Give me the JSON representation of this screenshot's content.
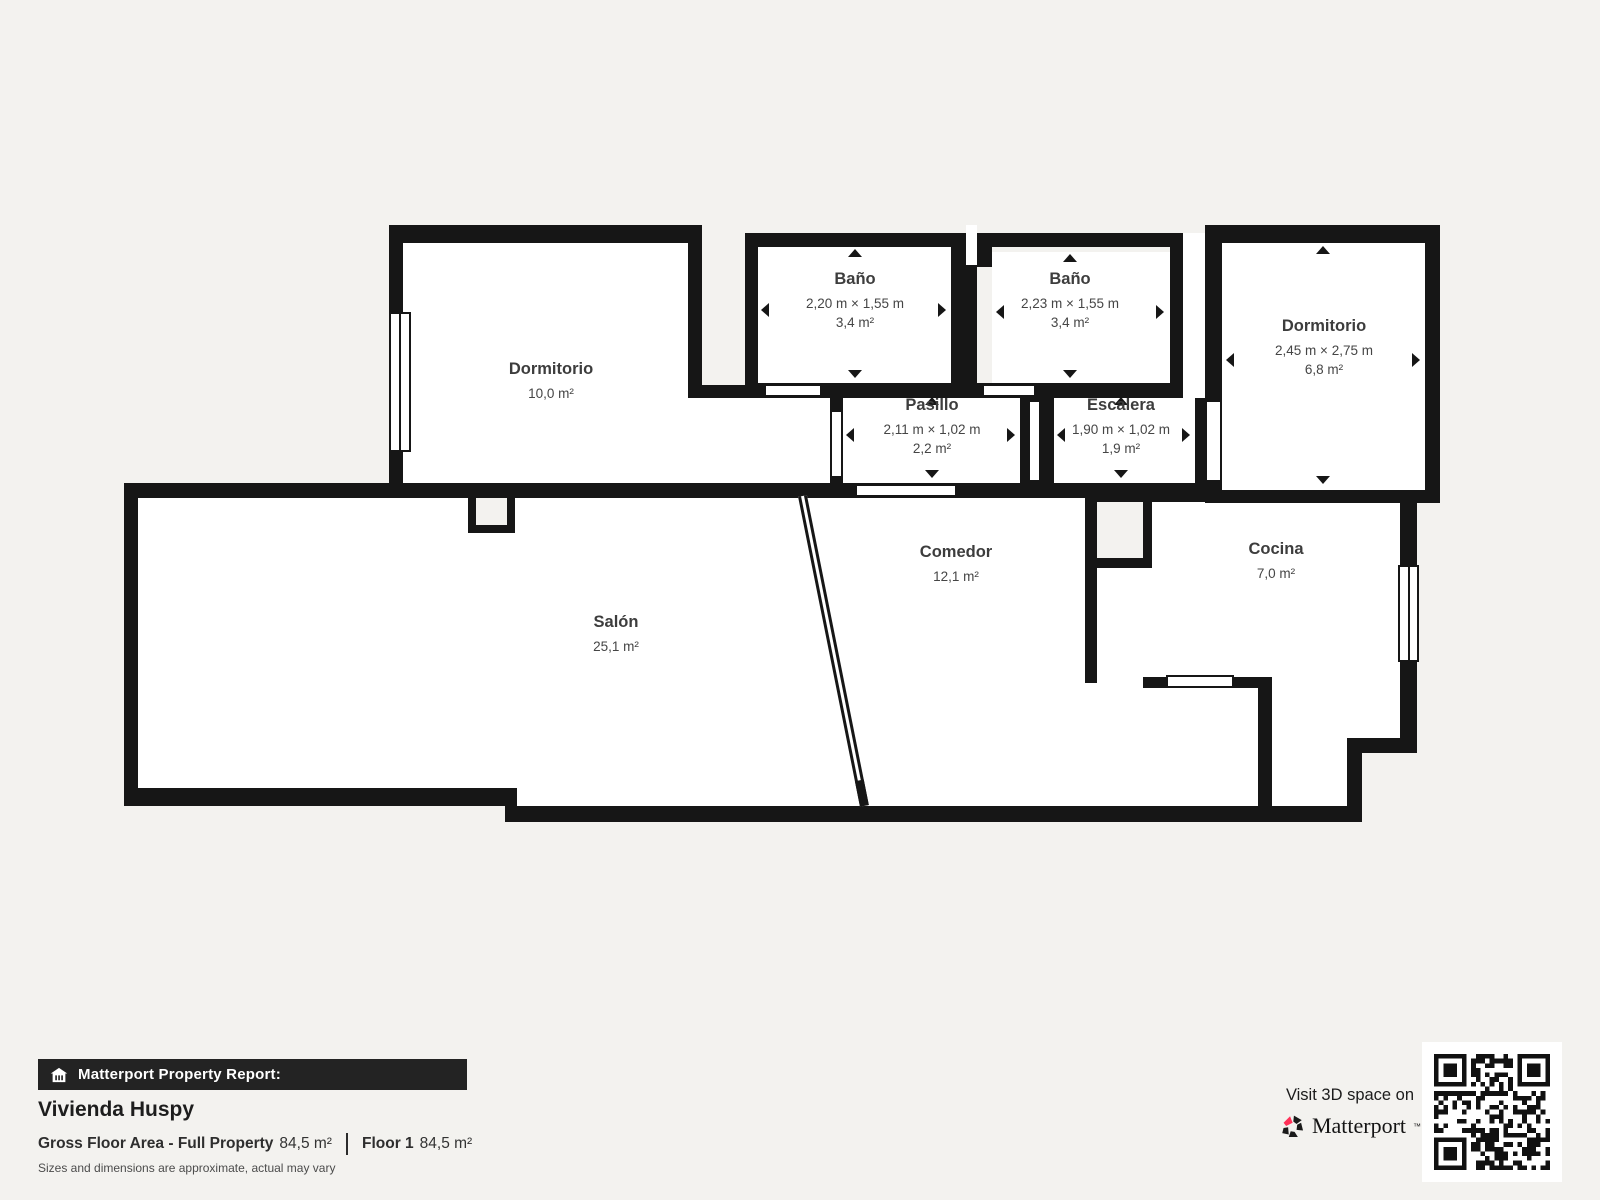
{
  "plan": {
    "rooms": {
      "dormitorio_left": {
        "name": "Dormitorio",
        "area": "10,0 m²"
      },
      "bano1": {
        "name": "Baño",
        "dims": "2,20 m × 1,55 m",
        "area": "3,4 m²"
      },
      "bano2": {
        "name": "Baño",
        "dims": "2,23 m × 1,55 m",
        "area": "3,4 m²"
      },
      "dormitorio_right": {
        "name": "Dormitorio",
        "dims": "2,45 m × 2,75 m",
        "area": "6,8 m²"
      },
      "pasillo": {
        "name": "Pasillo",
        "dims": "2,11 m × 1,02 m",
        "area": "2,2 m²"
      },
      "escalera": {
        "name": "Escalera",
        "dims": "1,90 m × 1,02 m",
        "area": "1,9 m²"
      },
      "salon": {
        "name": "Salón",
        "area": "25,1 m²"
      },
      "comedor": {
        "name": "Comedor",
        "area": "12,1 m²"
      },
      "cocina": {
        "name": "Cocina",
        "area": "7,0 m²"
      }
    }
  },
  "footer": {
    "report_label": "Matterport Property Report:",
    "property_name": "Vivienda Huspy",
    "gfa_label": "Gross Floor Area - Full Property",
    "gfa_value": "84,5 m²",
    "floor_label": "Floor 1",
    "floor_value": "84,5 m²",
    "disclaimer": "Sizes and dimensions are approximate, actual may vary"
  },
  "promo": {
    "visit_text": "Visit 3D space on",
    "brand": "Matterport",
    "trademark": "™"
  },
  "colors": {
    "wall": "#161616",
    "background": "#f3f2ef",
    "room_fill": "#ffffff",
    "brand_pink": "#ff3158",
    "bar_background": "#232323"
  }
}
